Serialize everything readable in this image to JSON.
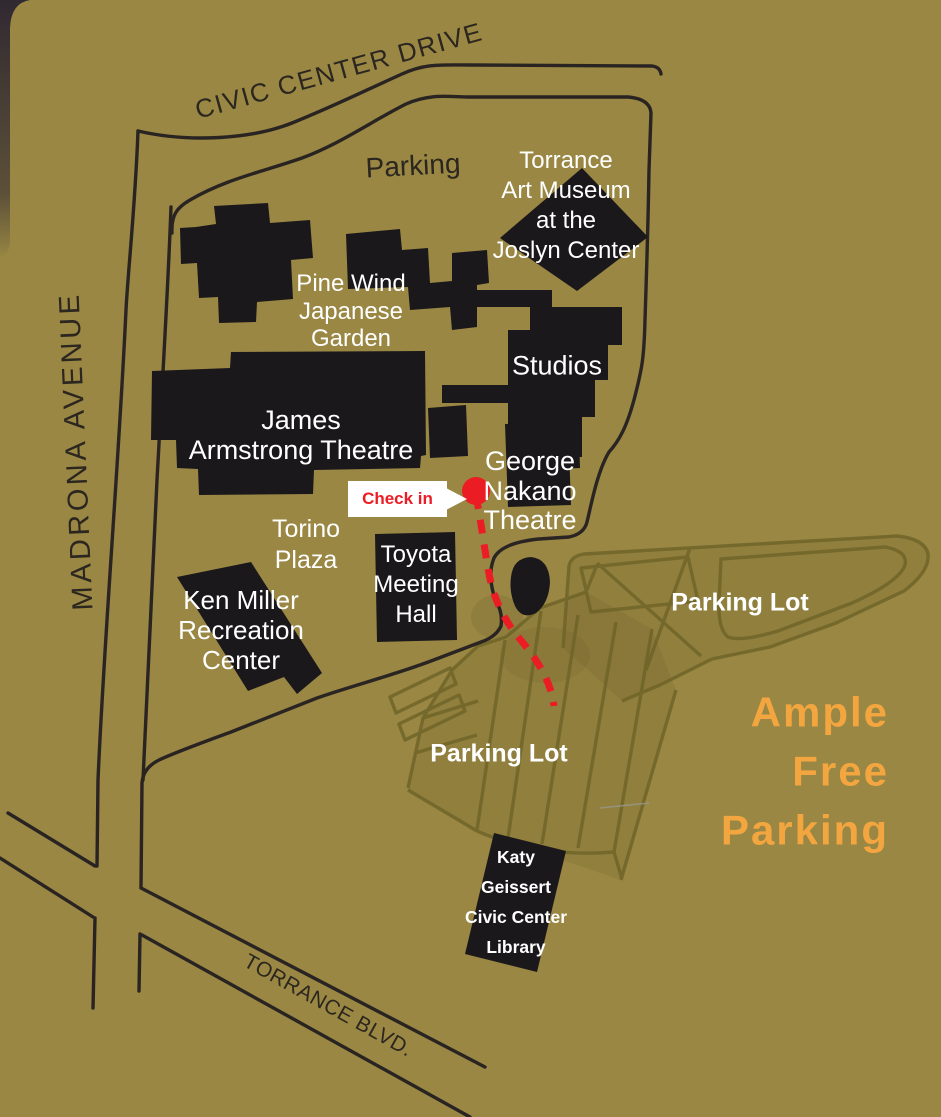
{
  "streets": {
    "civic_center_drive": "CIVIC CENTER DRIVE",
    "madrona_avenue": "MADRONA AVENUE",
    "torrance_blvd": "TORRANCE BLVD."
  },
  "labels": {
    "parking_top": "Parking",
    "torrance_art_museum": "Torrance\nArt Museum\nat the\nJoslyn Center",
    "pine_wind": "Pine Wind\nJapanese\nGarden",
    "studios": "Studios",
    "james_armstrong": "James\nArmstrong Theatre",
    "george_nakano": "George\nNakano\nTheatre",
    "torino_plaza": "Torino\nPlaza",
    "toyota_meeting_hall": "Toyota\nMeeting\nHall",
    "ken_miller": "Ken Miller\nRecreation\nCenter",
    "parking_lot_right": "Parking Lot",
    "parking_lot_lower": "Parking Lot",
    "katy_geissert": "Katy\nGeissert\nCivic Center\nLibrary",
    "ample_free_parking": "Ample\nFree\nParking"
  },
  "callout": {
    "check_in": "Check in"
  },
  "colors": {
    "background": "#998743",
    "building": "#1b181c",
    "road": "#211d20",
    "lot_line": "#6f6428",
    "accent_red": "#ec1c24",
    "accent_orange": "#f3a63f",
    "dark_text": "#2b261f",
    "white_text": "#ffffff"
  }
}
